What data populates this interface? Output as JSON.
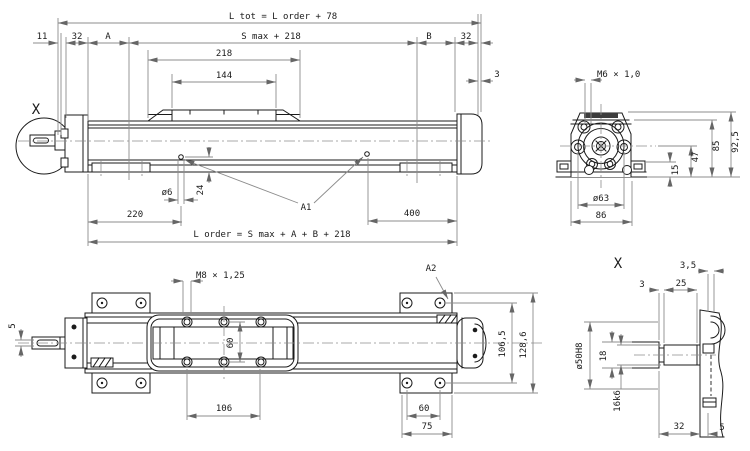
{
  "side_view": {
    "detail_marker": "X",
    "labels": {
      "a1": "A1"
    },
    "dims": {
      "l_tot": "L tot = L order + 78",
      "s_max": "S max + 218",
      "d11": "11",
      "d32_left": "32",
      "a": "A",
      "b": "B",
      "d32_right": "32",
      "d218": "218",
      "d144": "144",
      "d3": "3",
      "dia6": "ø6",
      "d24": "24",
      "d220": "220",
      "d400": "400",
      "l_order": "L order = S max + A + B + 218"
    }
  },
  "end_view": {
    "dims": {
      "m6": "M6 × 1,0",
      "d15": "15",
      "d47": "47",
      "d85": "85",
      "d92_5": "92,5",
      "dia63": "ø63",
      "d86": "86"
    }
  },
  "plan_view": {
    "labels": {
      "a2": "A2"
    },
    "dims": {
      "m8": "M8 × 1,25",
      "d5": "5",
      "d60_carriage": "60",
      "d106": "106",
      "d60_feet": "60",
      "d75": "75",
      "d106_5": "106,5",
      "d128_6": "128,6"
    }
  },
  "detail_view": {
    "detail_marker": "X",
    "dims": {
      "d3_5": "3,5",
      "d3": "3",
      "d25": "25",
      "dia50": "ø50H8",
      "d18": "18",
      "d16k6": "16k6",
      "d32": "32",
      "d5": "5"
    }
  },
  "colors": {
    "object_line": "#1b1b1b",
    "dimension_line": "#8c8c8c",
    "background": "#ffffff"
  }
}
